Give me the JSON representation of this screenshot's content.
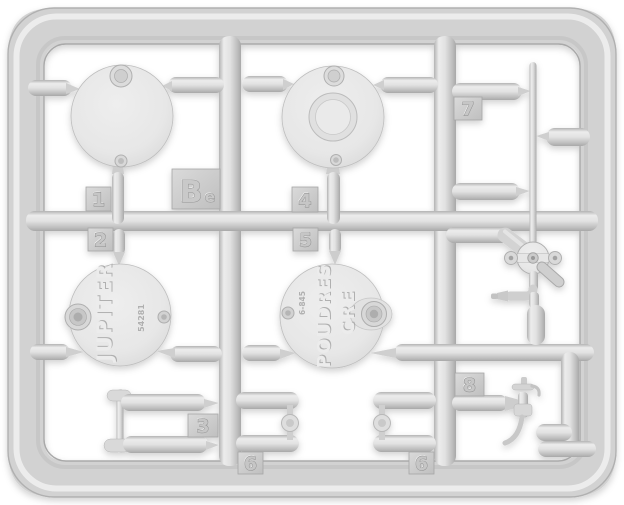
{
  "scene": {
    "subject": "Light gray injection-molded plastic model kit sprue with round lid parts, valve and faucet fittings, photographed on a white background",
    "plastic_color": "#d6d6d6",
    "background_color": "#ffffff"
  },
  "sprue": {
    "letter_main": "B",
    "letter_sub": "e"
  },
  "part_tabs": {
    "t1": "1",
    "t2": "2",
    "t3": "3",
    "t4": "4",
    "t5": "5",
    "t6a": "6",
    "t6b": "6",
    "t7": "7",
    "t8": "8"
  },
  "lid_jupiter": {
    "name": "JUPITER",
    "code": "54281"
  },
  "lid_poudres": {
    "word1": "POUDRES",
    "word2": "CRE",
    "code": "6-845"
  }
}
